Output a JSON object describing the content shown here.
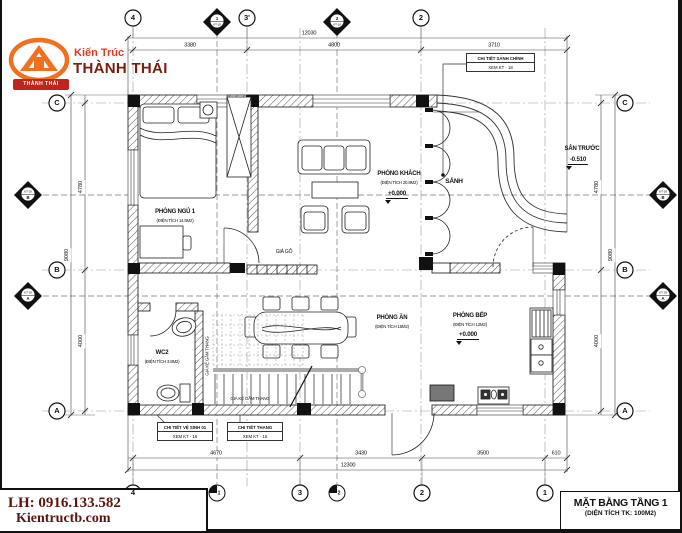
{
  "brand": {
    "tagline": "Kiến Trúc",
    "name": "THÀNH THÁI",
    "badge": "THÀNH THÁI",
    "accent": "#f07020",
    "dark_red": "#7a1d10"
  },
  "contact": {
    "phone": "LH: 0916.133.582",
    "website": "Kientructb.com"
  },
  "title_block": {
    "title": "MẶT BẰNG TẦNG 1",
    "subtitle": "(DIỆN TÍCH TK: 100M2)"
  },
  "rooms": {
    "bedroom": {
      "name": "PHÒNG NGỦ 1",
      "area": "(ĐIỆN TÍCH 14.5M2)"
    },
    "living": {
      "name": "PHÒNG KHÁCH",
      "area": "(ĐIỆN TÍCH 20.8M2)",
      "level": "+0.000"
    },
    "hall": {
      "name": "SẢNH"
    },
    "yard": {
      "name": "SÂN TRƯỚC",
      "level": "-0.510"
    },
    "dining": {
      "name": "PHÒNG ĂN",
      "area": "(ĐIỆN TÍCH 15M2)"
    },
    "kitchen": {
      "name": "PHÒNG BẾP",
      "area": "(ĐIỆN TÍCH 12M2)",
      "level": "+0.000"
    },
    "wc": {
      "name": "WC2",
      "area": "(ĐIỆN TÍCH 3.8M2)"
    },
    "wood_shelf": {
      "name": "GIÁ GỖ"
    },
    "stair_shelf": {
      "name": "GIÁ KỆ GẦM THANG"
    }
  },
  "callouts": {
    "main_hall": {
      "line1": "CHI TIẾT SẢNH CHÍNH",
      "line2": "XEM KT - 18"
    },
    "wc_detail": {
      "line1": "CHI TIẾT VỆ SINH 01",
      "line2": "XEM KT - 16"
    },
    "stair_detail": {
      "line1": "CHI TIẾT THANG",
      "line2": "XEM KT - 15"
    }
  },
  "dimensions": {
    "top": {
      "segments": [
        "3380",
        "4800",
        "3710"
      ],
      "total": "12030"
    },
    "bottom": {
      "segments": [
        "4670",
        "3430",
        "3500",
        "610"
      ],
      "total": "12300"
    },
    "left": {
      "segments": [
        "4780",
        "4000"
      ],
      "total": "9080"
    },
    "right": {
      "segments": [
        "4780",
        "4000"
      ],
      "total": "9080"
    }
  },
  "axes": {
    "top_circles": [
      "4",
      "3'",
      "2"
    ],
    "bottom_circles": [
      "4",
      "3",
      "2",
      "1"
    ],
    "left_circles": [
      "C",
      "B",
      "A"
    ],
    "right_circles": [
      "C",
      "B",
      "A"
    ],
    "sections": {
      "s1": "1",
      "s2": "2",
      "sB": "B",
      "sA": "A",
      "ref": "KT-18"
    }
  }
}
